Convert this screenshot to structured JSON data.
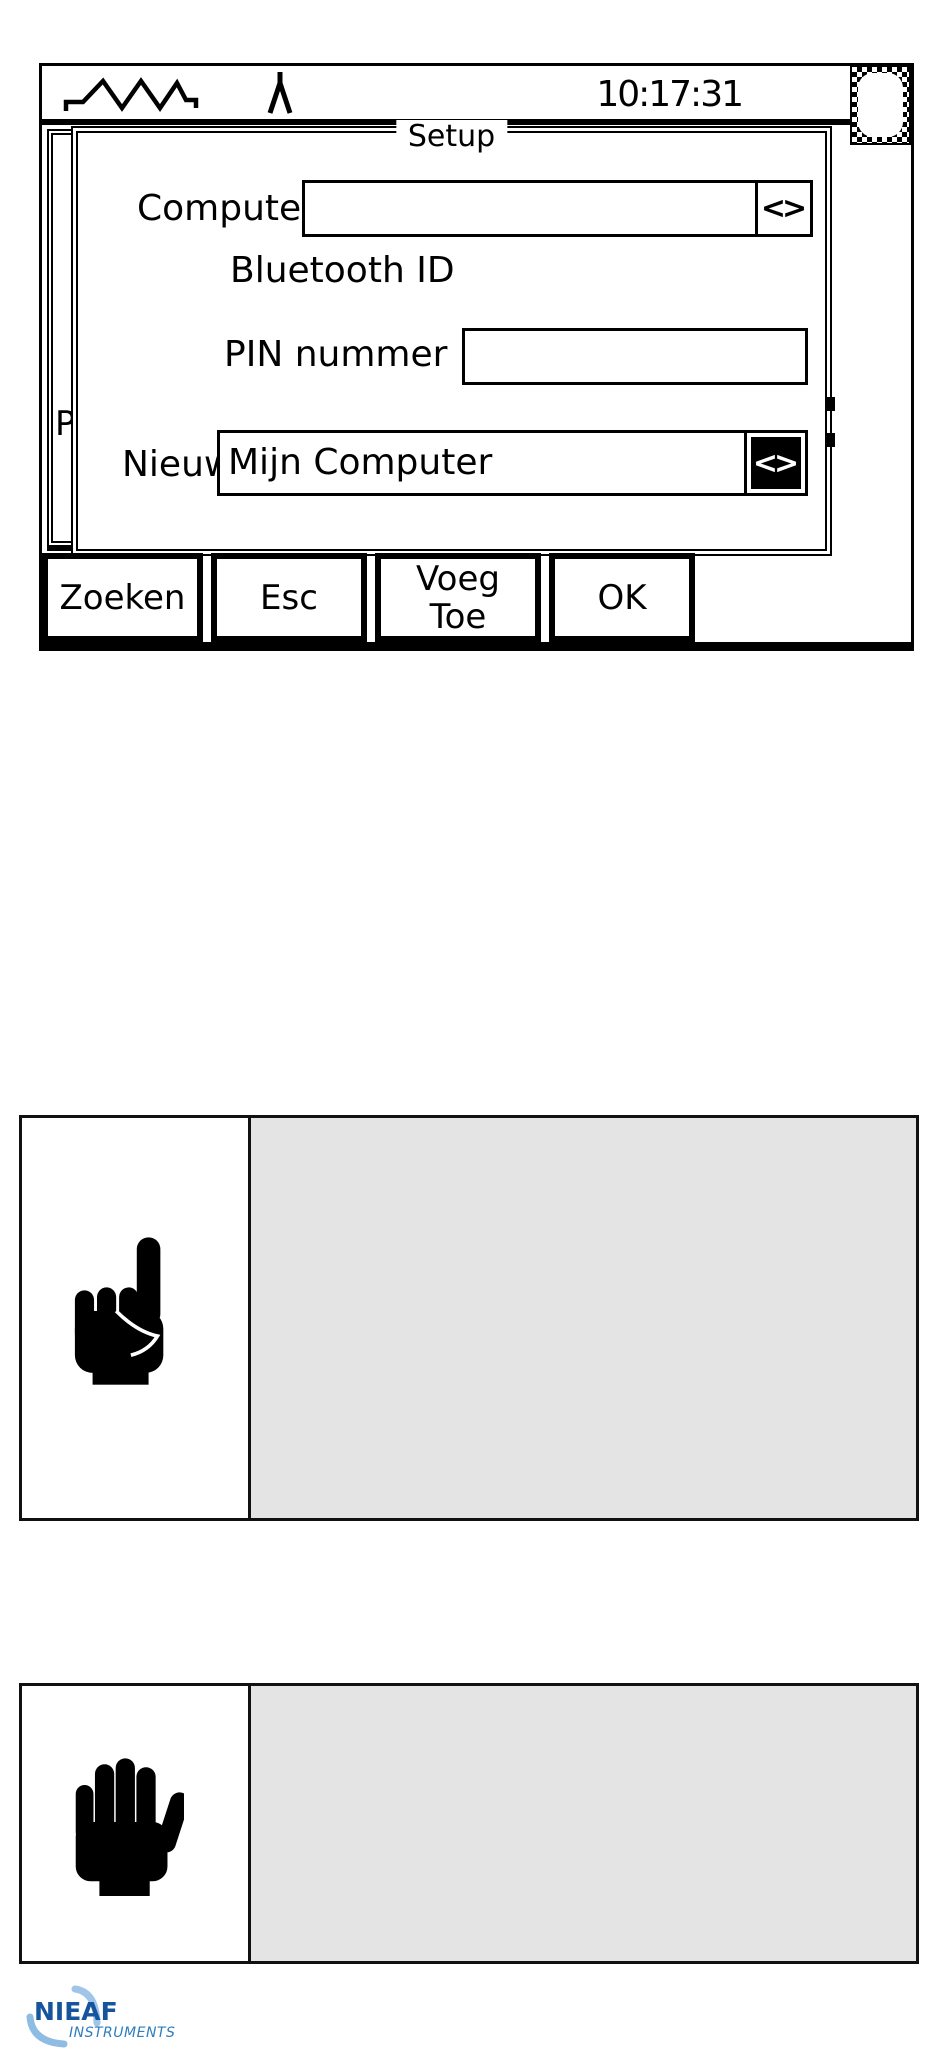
{
  "device_screen": {
    "status_bar": {
      "time": "10:17:31",
      "icons": [
        "waveform-icon",
        "peak-icon",
        "battery-icon"
      ]
    },
    "background_window": {
      "clipped_label": "P"
    },
    "setup_dialog": {
      "title": "Setup",
      "rows": [
        {
          "label": "Computer",
          "value": "",
          "spinner": "<>"
        },
        {
          "label": "Bluetooth ID"
        },
        {
          "label": "PIN nummer",
          "value": ""
        },
        {
          "label": "Nieuw",
          "value": "Mijn Computer",
          "spinner": "<>"
        }
      ]
    },
    "softkeys": [
      {
        "label": "Zoeken"
      },
      {
        "label": "Esc"
      },
      {
        "label": "Voeg\nToe"
      },
      {
        "label": "OK"
      }
    ]
  },
  "note_box": {
    "icon": "pointing-finger-icon",
    "text": ""
  },
  "warning_box": {
    "icon": "stop-hand-icon",
    "text": ""
  },
  "logo": {
    "brand": "NIEAF",
    "subtitle": "INSTRUMENTS"
  },
  "colors": {
    "screen_ink": "#000000",
    "note_panel_gray": "#e4e4e4",
    "logo_dark_blue": "#17549e",
    "logo_mid_blue": "#2d7dbf",
    "logo_light_blue": "#9fc6e8"
  }
}
